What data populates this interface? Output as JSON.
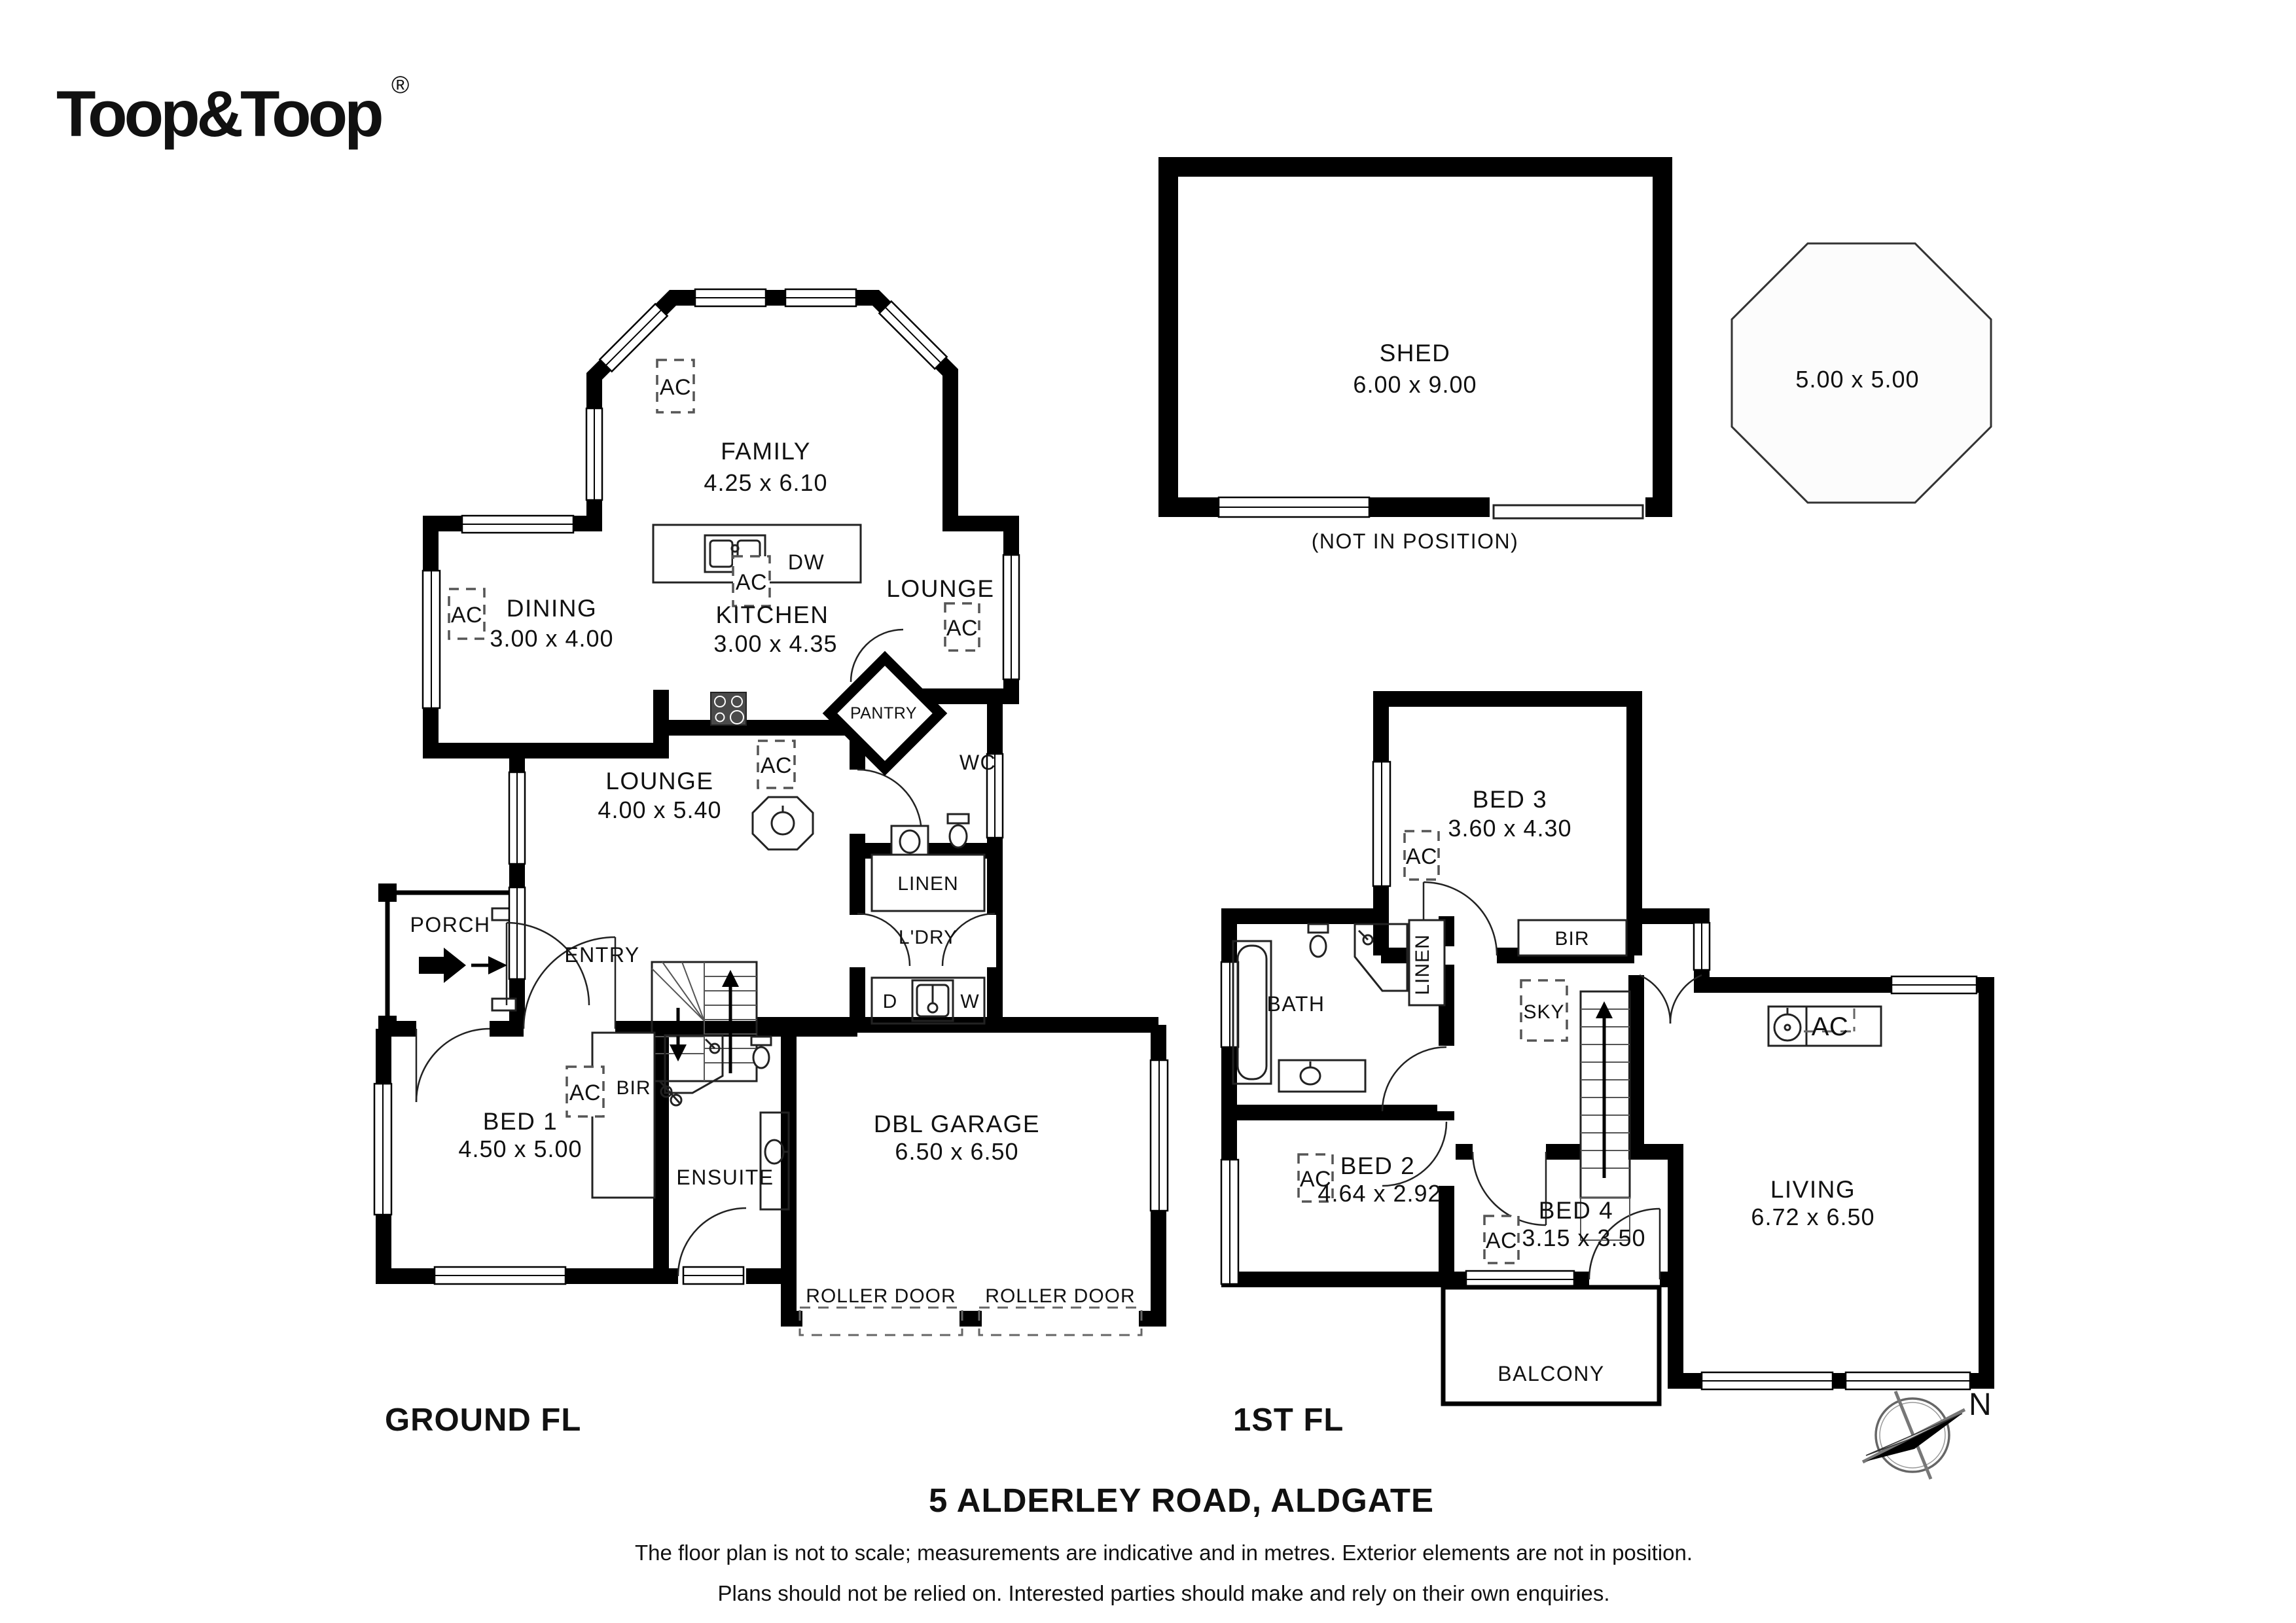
{
  "logo": {
    "brand": "Toop&Toop",
    "registered": "®"
  },
  "labels": {
    "ac": "AC",
    "dw": "DW",
    "d": "D",
    "w": "W",
    "wc": "WC",
    "linen": "LINEN",
    "ldry": "L'DRY",
    "pantry": "PANTRY",
    "bir": "BIR",
    "roller_door": "ROLLER DOOR",
    "entry": "ENTRY",
    "porch": "PORCH",
    "sky": "SKY",
    "north": "N"
  },
  "ground": {
    "title": "GROUND FL",
    "family": {
      "name": "FAMILY",
      "dims": "4.25 x 6.10"
    },
    "dining": {
      "name": "DINING",
      "dims": "3.00 x 4.00"
    },
    "kitchen": {
      "name": "KITCHEN",
      "dims": "3.00 x 4.35"
    },
    "lounge_rear": {
      "name": "LOUNGE"
    },
    "lounge": {
      "name": "LOUNGE",
      "dims": "4.00 x 5.40"
    },
    "bed1": {
      "name": "BED 1",
      "dims": "4.50 x 5.00"
    },
    "ensuite": {
      "name": "ENSUITE"
    },
    "garage": {
      "name": "DBL GARAGE",
      "dims": "6.50 x 6.50"
    }
  },
  "first": {
    "title": "1ST FL",
    "bed3": {
      "name": "BED 3",
      "dims": "3.60 x 4.30"
    },
    "bed2": {
      "name": "BED 2",
      "dims": "4.64 x 2.92"
    },
    "bed4": {
      "name": "BED 4",
      "dims": "3.15 x 3.50"
    },
    "living": {
      "name": "LIVING",
      "dims": "6.72 x 6.50"
    },
    "bath": {
      "name": "BATH"
    },
    "balcony": {
      "name": "BALCONY"
    }
  },
  "outbuildings": {
    "shed": {
      "name": "SHED",
      "dims": "6.00 x 9.00",
      "note": "(NOT IN POSITION)"
    },
    "gazebo": {
      "dims": "5.00 x 5.00"
    }
  },
  "footer": {
    "address": "5 ALDERLEY ROAD, ALDGATE",
    "disclaimer1": "The floor plan is not to scale; measurements are indicative and in metres. Exterior elements are not in position.",
    "disclaimer2": "Plans should not be relied on. Interested parties should make and rely on their own enquiries."
  },
  "colors": {
    "wall": "#000000",
    "text": "#111111",
    "background": "#ffffff"
  }
}
